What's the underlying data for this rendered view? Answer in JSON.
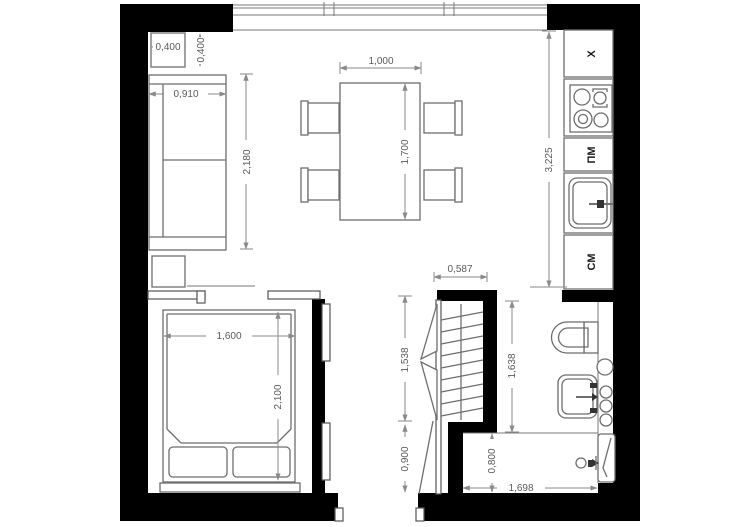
{
  "floorplan": {
    "dimensions": {
      "side_table_w": "0,400",
      "side_table_d": "0,400",
      "sofa_w": "0,910",
      "sofa_l": "2,180",
      "dining_table_w": "1,000",
      "dining_table_l": "1,700",
      "kitchen_run": "3,225",
      "closet_w": "0,587",
      "closet_d": "1,538",
      "entry_hall_d": "0,900",
      "bed_w": "1,600",
      "bed_l": "2,100",
      "bathroom_d": "1,638",
      "bathtub_w": "0,800",
      "bathroom_w": "1,698"
    },
    "appliance_labels": {
      "fridge": "X",
      "dishwasher": "ПМ",
      "washing_machine": "СМ"
    },
    "colors": {
      "wall": "#000000",
      "furniture_line": "#6e6e6e",
      "dimension_line": "#8a8a8a",
      "dimension_text": "#5a5a5a",
      "background": "#ffffff"
    }
  }
}
